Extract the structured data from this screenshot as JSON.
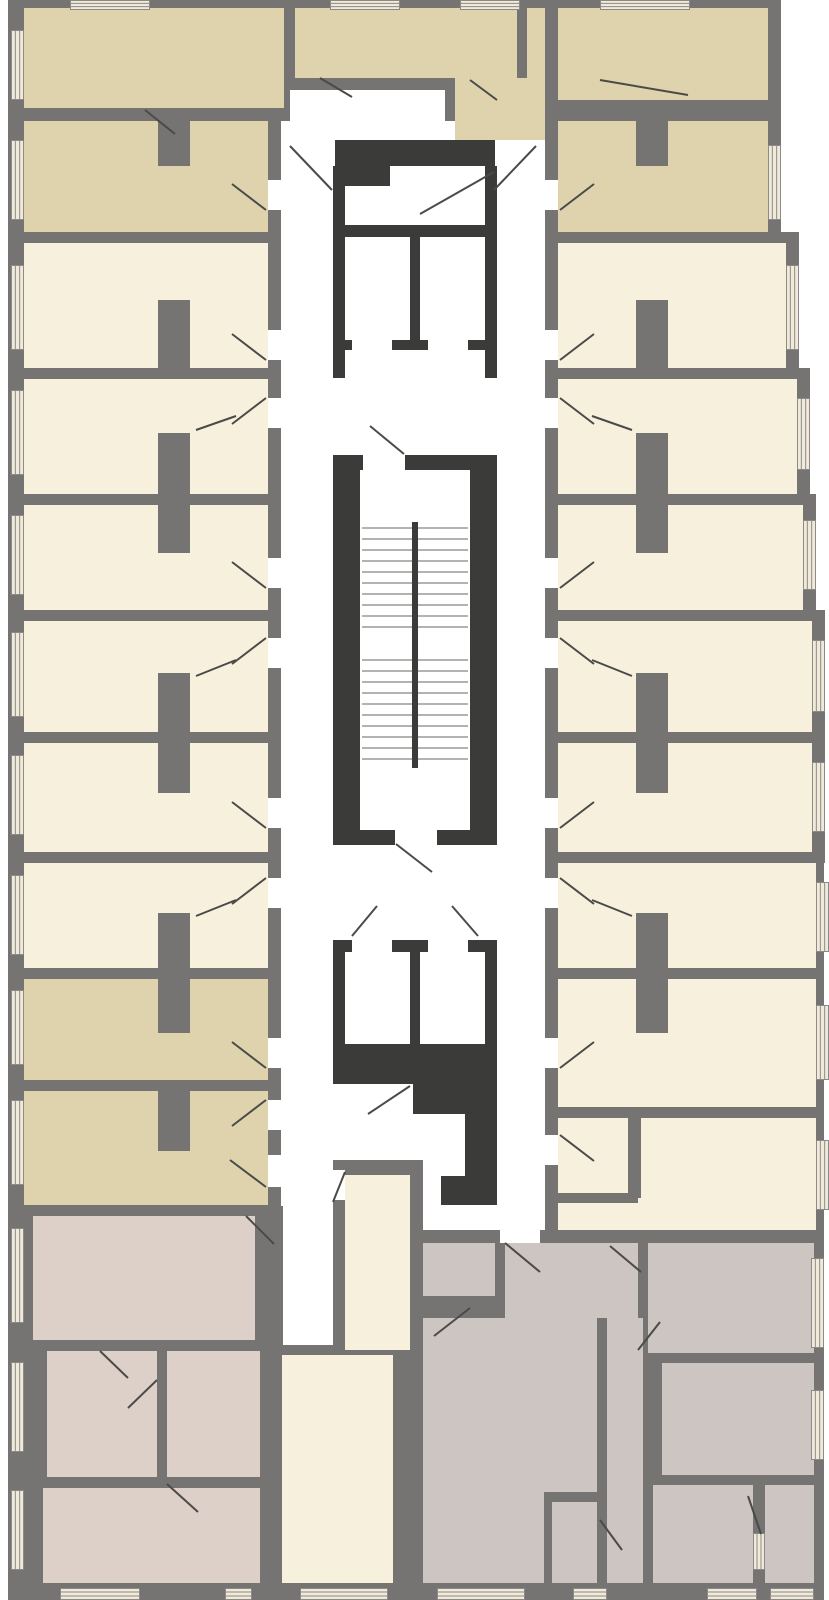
{
  "plan": {
    "canvas": {
      "width": 829,
      "height": 1600
    },
    "palette": {
      "wall": "#757473",
      "dark": "#3b3b39",
      "tan": "#ded3ac",
      "cream": "#f6f0dd",
      "mauve": "#dcd0c8",
      "gmau": "#cdc5c1",
      "white": "#ffffff",
      "window_fill": "#f1ead9",
      "window_line": "#8b8a88",
      "tread": "#9a9a98",
      "swing": "#4a4a48"
    },
    "slabs": [
      [
        8,
        0,
        282,
        121
      ],
      [
        290,
        0,
        170,
        90
      ],
      [
        445,
        0,
        113,
        140
      ],
      [
        545,
        0,
        236,
        121
      ],
      [
        8,
        110,
        273,
        1106
      ],
      [
        545,
        90,
        236,
        153
      ],
      [
        545,
        232,
        254,
        147
      ],
      [
        545,
        368,
        265,
        137
      ],
      [
        545,
        494,
        271,
        127
      ],
      [
        545,
        610,
        280,
        133
      ],
      [
        545,
        732,
        280,
        131
      ],
      [
        545,
        852,
        279,
        127
      ],
      [
        545,
        968,
        279,
        150
      ],
      [
        545,
        1107,
        279,
        136
      ],
      [
        333,
        1155,
        90,
        445
      ],
      [
        270,
        1345,
        63,
        255
      ],
      [
        8,
        1205,
        275,
        395
      ],
      [
        413,
        1230,
        411,
        370
      ]
    ],
    "corridors": [
      [
        290,
        90,
        155,
        31
      ],
      [
        281,
        121,
        264,
        1039
      ],
      [
        281,
        1160,
        52,
        46
      ],
      [
        423,
        1160,
        122,
        70
      ]
    ],
    "rooms": [
      {
        "r": [
          24,
          8,
          260,
          100
        ],
        "c": "tan"
      },
      {
        "r": [
          295,
          8,
          160,
          70
        ],
        "c": "tan"
      },
      {
        "r": [
          558,
          8,
          210,
          92
        ],
        "c": "tan"
      },
      {
        "r": [
          455,
          8,
          90,
          132
        ],
        "c": "tan"
      },
      {
        "r": [
          24,
          121,
          244,
          111
        ],
        "c": "tan"
      },
      {
        "r": [
          24,
          243,
          244,
          125
        ],
        "c": "cream"
      },
      {
        "r": [
          24,
          379,
          244,
          115
        ],
        "c": "cream"
      },
      {
        "r": [
          24,
          505,
          244,
          105
        ],
        "c": "cream"
      },
      {
        "r": [
          24,
          621,
          244,
          111
        ],
        "c": "cream"
      },
      {
        "r": [
          24,
          743,
          244,
          109
        ],
        "c": "cream"
      },
      {
        "r": [
          24,
          863,
          244,
          105
        ],
        "c": "cream"
      },
      {
        "r": [
          24,
          979,
          244,
          101
        ],
        "c": "tan"
      },
      {
        "r": [
          24,
          1091,
          244,
          114
        ],
        "c": "tan"
      },
      {
        "r": [
          558,
          121,
          210,
          111
        ],
        "c": "tan"
      },
      {
        "r": [
          558,
          243,
          228,
          125
        ],
        "c": "cream"
      },
      {
        "r": [
          558,
          379,
          239,
          115
        ],
        "c": "cream"
      },
      {
        "r": [
          558,
          505,
          245,
          105
        ],
        "c": "cream"
      },
      {
        "r": [
          558,
          621,
          254,
          111
        ],
        "c": "cream"
      },
      {
        "r": [
          558,
          743,
          254,
          109
        ],
        "c": "cream"
      },
      {
        "r": [
          558,
          863,
          258,
          105
        ],
        "c": "cream"
      },
      {
        "r": [
          558,
          979,
          258,
          128
        ],
        "c": "cream"
      },
      {
        "r": [
          558,
          1118,
          258,
          112
        ],
        "c": "cream"
      },
      {
        "r": [
          345,
          1175,
          65,
          175
        ],
        "c": "cream"
      },
      {
        "r": [
          282,
          1355,
          111,
          228
        ],
        "c": "cream"
      },
      {
        "r": [
          33,
          1216,
          222,
          124
        ],
        "c": "mauve"
      },
      {
        "r": [
          47,
          1351,
          110,
          126
        ],
        "c": "mauve"
      },
      {
        "r": [
          43,
          1488,
          217,
          95
        ],
        "c": "mauve"
      },
      {
        "r": [
          167,
          1351,
          93,
          126
        ],
        "c": "mauve"
      },
      {
        "r": [
          423,
          1243,
          72,
          53
        ],
        "c": "gmau"
      },
      {
        "r": [
          505,
          1243,
          133,
          75
        ],
        "c": "gmau"
      },
      {
        "r": [
          423,
          1318,
          174,
          265
        ],
        "c": "gmau"
      },
      {
        "r": [
          607,
          1318,
          36,
          265
        ],
        "c": "gmau"
      },
      {
        "r": [
          648,
          1243,
          166,
          110
        ],
        "c": "gmau"
      },
      {
        "r": [
          662,
          1363,
          152,
          112
        ],
        "c": "gmau"
      },
      {
        "r": [
          653,
          1485,
          100,
          98
        ],
        "c": "gmau"
      },
      {
        "r": [
          765,
          1485,
          49,
          98
        ],
        "c": "gmau"
      }
    ],
    "partitions": [
      [
        158,
        121,
        32,
        45
      ],
      [
        158,
        300,
        32,
        68
      ],
      [
        158,
        433,
        32,
        120
      ],
      [
        158,
        673,
        32,
        120
      ],
      [
        158,
        913,
        32,
        120
      ],
      [
        158,
        1091,
        32,
        60
      ],
      [
        636,
        121,
        32,
        45
      ],
      [
        636,
        300,
        32,
        68
      ],
      [
        636,
        433,
        32,
        120
      ],
      [
        636,
        673,
        32,
        120
      ],
      [
        636,
        913,
        32,
        120
      ],
      [
        517,
        8,
        10,
        70
      ],
      [
        628,
        1118,
        13,
        80
      ],
      [
        558,
        1193,
        80,
        10
      ],
      [
        544,
        1492,
        54,
        10
      ],
      [
        544,
        1502,
        8,
        81
      ]
    ],
    "core_walls": [
      [
        335,
        140,
        160,
        26
      ],
      [
        335,
        140,
        55,
        46
      ],
      [
        333,
        166,
        12,
        59
      ],
      [
        485,
        166,
        12,
        59
      ],
      [
        333,
        225,
        164,
        125
      ],
      [
        333,
        350,
        12,
        28
      ],
      [
        485,
        350,
        12,
        28
      ],
      [
        333,
        455,
        164,
        15
      ],
      [
        333,
        470,
        27,
        360
      ],
      [
        470,
        470,
        27,
        360
      ],
      [
        333,
        830,
        164,
        15
      ],
      [
        333,
        940,
        164,
        116
      ],
      [
        333,
        1056,
        164,
        28
      ],
      [
        413,
        1084,
        84,
        30
      ],
      [
        465,
        1114,
        32,
        62
      ],
      [
        441,
        1176,
        56,
        29
      ]
    ],
    "shaft_interiors": [
      [
        345,
        237,
        65,
        103
      ],
      [
        420,
        237,
        65,
        103
      ],
      [
        360,
        470,
        110,
        360
      ],
      [
        345,
        952,
        65,
        92
      ],
      [
        420,
        952,
        65,
        92
      ]
    ],
    "door_openings": [
      [
        352,
        340,
        40,
        12
      ],
      [
        428,
        340,
        40,
        12
      ],
      [
        363,
        455,
        42,
        15
      ],
      [
        395,
        830,
        42,
        15
      ],
      [
        352,
        938,
        40,
        14
      ],
      [
        428,
        938,
        40,
        14
      ],
      [
        268,
        180,
        13,
        30
      ],
      [
        268,
        330,
        13,
        30
      ],
      [
        268,
        398,
        13,
        30
      ],
      [
        268,
        558,
        13,
        30
      ],
      [
        268,
        638,
        13,
        30
      ],
      [
        268,
        798,
        13,
        30
      ],
      [
        268,
        878,
        13,
        30
      ],
      [
        268,
        1038,
        13,
        30
      ],
      [
        268,
        1100,
        13,
        30
      ],
      [
        268,
        1155,
        13,
        32
      ],
      [
        545,
        180,
        13,
        30
      ],
      [
        545,
        330,
        13,
        30
      ],
      [
        545,
        398,
        13,
        30
      ],
      [
        545,
        558,
        13,
        30
      ],
      [
        545,
        638,
        13,
        30
      ],
      [
        545,
        798,
        13,
        30
      ],
      [
        545,
        878,
        13,
        30
      ],
      [
        545,
        1038,
        13,
        30
      ],
      [
        545,
        1135,
        13,
        30
      ],
      [
        500,
        1230,
        40,
        13
      ],
      [
        333,
        1170,
        12,
        30
      ]
    ],
    "stairs": {
      "x1": 362,
      "x2": 468,
      "runs": [
        {
          "y": 528,
          "n": 10,
          "step": 11
        },
        {
          "y": 660,
          "n": 10,
          "step": 11
        }
      ],
      "stringer": [
        412,
        522,
        6,
        246
      ]
    },
    "windows": [
      {
        "r": [
          11,
          30,
          13,
          70
        ],
        "o": "v"
      },
      {
        "r": [
          11,
          140,
          13,
          80
        ],
        "o": "v"
      },
      {
        "r": [
          11,
          265,
          13,
          85
        ],
        "o": "v"
      },
      {
        "r": [
          11,
          390,
          13,
          85
        ],
        "o": "v"
      },
      {
        "r": [
          11,
          515,
          13,
          80
        ],
        "o": "v"
      },
      {
        "r": [
          11,
          632,
          13,
          85
        ],
        "o": "v"
      },
      {
        "r": [
          11,
          755,
          13,
          80
        ],
        "o": "v"
      },
      {
        "r": [
          11,
          875,
          13,
          80
        ],
        "o": "v"
      },
      {
        "r": [
          11,
          990,
          13,
          75
        ],
        "o": "v"
      },
      {
        "r": [
          11,
          1100,
          13,
          85
        ],
        "o": "v"
      },
      {
        "r": [
          11,
          1228,
          13,
          95
        ],
        "o": "v"
      },
      {
        "r": [
          11,
          1362,
          13,
          90
        ],
        "o": "v"
      },
      {
        "r": [
          11,
          1490,
          13,
          80
        ],
        "o": "v"
      },
      {
        "r": [
          768,
          145,
          13,
          75
        ],
        "o": "v"
      },
      {
        "r": [
          786,
          265,
          13,
          85
        ],
        "o": "v"
      },
      {
        "r": [
          797,
          398,
          13,
          72
        ],
        "o": "v"
      },
      {
        "r": [
          803,
          520,
          13,
          70
        ],
        "o": "v"
      },
      {
        "r": [
          812,
          640,
          13,
          72
        ],
        "o": "v"
      },
      {
        "r": [
          812,
          762,
          13,
          70
        ],
        "o": "v"
      },
      {
        "r": [
          816,
          882,
          13,
          70
        ],
        "o": "v"
      },
      {
        "r": [
          816,
          1005,
          13,
          75
        ],
        "o": "v"
      },
      {
        "r": [
          816,
          1140,
          13,
          70
        ],
        "o": "v"
      },
      {
        "r": [
          811,
          1258,
          13,
          90
        ],
        "o": "v"
      },
      {
        "r": [
          811,
          1390,
          13,
          70
        ],
        "o": "v"
      },
      {
        "r": [
          70,
          0,
          80,
          10
        ],
        "o": "h"
      },
      {
        "r": [
          330,
          0,
          70,
          10
        ],
        "o": "h"
      },
      {
        "r": [
          460,
          0,
          60,
          10
        ],
        "o": "h"
      },
      {
        "r": [
          600,
          0,
          90,
          10
        ],
        "o": "h"
      },
      {
        "r": [
          60,
          1588,
          80,
          12
        ],
        "o": "h"
      },
      {
        "r": [
          225,
          1588,
          27,
          12
        ],
        "o": "h"
      },
      {
        "r": [
          300,
          1588,
          88,
          12
        ],
        "o": "h"
      },
      {
        "r": [
          437,
          1588,
          88,
          12
        ],
        "o": "h"
      },
      {
        "r": [
          573,
          1588,
          34,
          12
        ],
        "o": "h"
      },
      {
        "r": [
          707,
          1588,
          50,
          12
        ],
        "o": "h"
      },
      {
        "r": [
          770,
          1588,
          44,
          12
        ],
        "o": "h"
      },
      {
        "r": [
          753,
          1533,
          12,
          37
        ],
        "o": "v"
      }
    ],
    "door_swings": [
      [
        320,
        78,
        352,
        97
      ],
      [
        600,
        80,
        688,
        95
      ],
      [
        145,
        110,
        175,
        134
      ],
      [
        470,
        80,
        497,
        100
      ],
      [
        290,
        146,
        332,
        190
      ],
      [
        536,
        146,
        494,
        190
      ],
      [
        494,
        172,
        420,
        214
      ],
      [
        404,
        454,
        370,
        426
      ],
      [
        396,
        844,
        432,
        872
      ],
      [
        352,
        936,
        377,
        906
      ],
      [
        478,
        936,
        452,
        906
      ],
      [
        410,
        1086,
        368,
        1114
      ],
      [
        345,
        1172,
        333,
        1202
      ],
      [
        266,
        210,
        232,
        184
      ],
      [
        266,
        360,
        232,
        334
      ],
      [
        266,
        398,
        232,
        424
      ],
      [
        266,
        588,
        232,
        562
      ],
      [
        266,
        638,
        232,
        664
      ],
      [
        266,
        828,
        232,
        802
      ],
      [
        266,
        878,
        232,
        904
      ],
      [
        266,
        1068,
        232,
        1042
      ],
      [
        266,
        1100,
        232,
        1126
      ],
      [
        266,
        1187,
        230,
        1160
      ],
      [
        560,
        210,
        594,
        184
      ],
      [
        560,
        360,
        594,
        334
      ],
      [
        560,
        398,
        594,
        424
      ],
      [
        560,
        588,
        594,
        562
      ],
      [
        560,
        638,
        594,
        664
      ],
      [
        560,
        828,
        594,
        802
      ],
      [
        560,
        878,
        594,
        904
      ],
      [
        560,
        1068,
        594,
        1042
      ],
      [
        560,
        1135,
        594,
        1161
      ],
      [
        196,
        430,
        236,
        416
      ],
      [
        196,
        676,
        236,
        660
      ],
      [
        196,
        916,
        236,
        900
      ],
      [
        632,
        430,
        592,
        416
      ],
      [
        632,
        676,
        592,
        660
      ],
      [
        632,
        916,
        592,
        900
      ],
      [
        505,
        1243,
        540,
        1272
      ],
      [
        470,
        1308,
        434,
        1336
      ],
      [
        610,
        1246,
        641,
        1272
      ],
      [
        600,
        1520,
        622,
        1550
      ],
      [
        748,
        1496,
        761,
        1534
      ],
      [
        638,
        1350,
        660,
        1322
      ],
      [
        246,
        1216,
        274,
        1244
      ],
      [
        157,
        1380,
        128,
        1408
      ],
      [
        167,
        1484,
        198,
        1512
      ],
      [
        100,
        1351,
        128,
        1378
      ]
    ]
  }
}
